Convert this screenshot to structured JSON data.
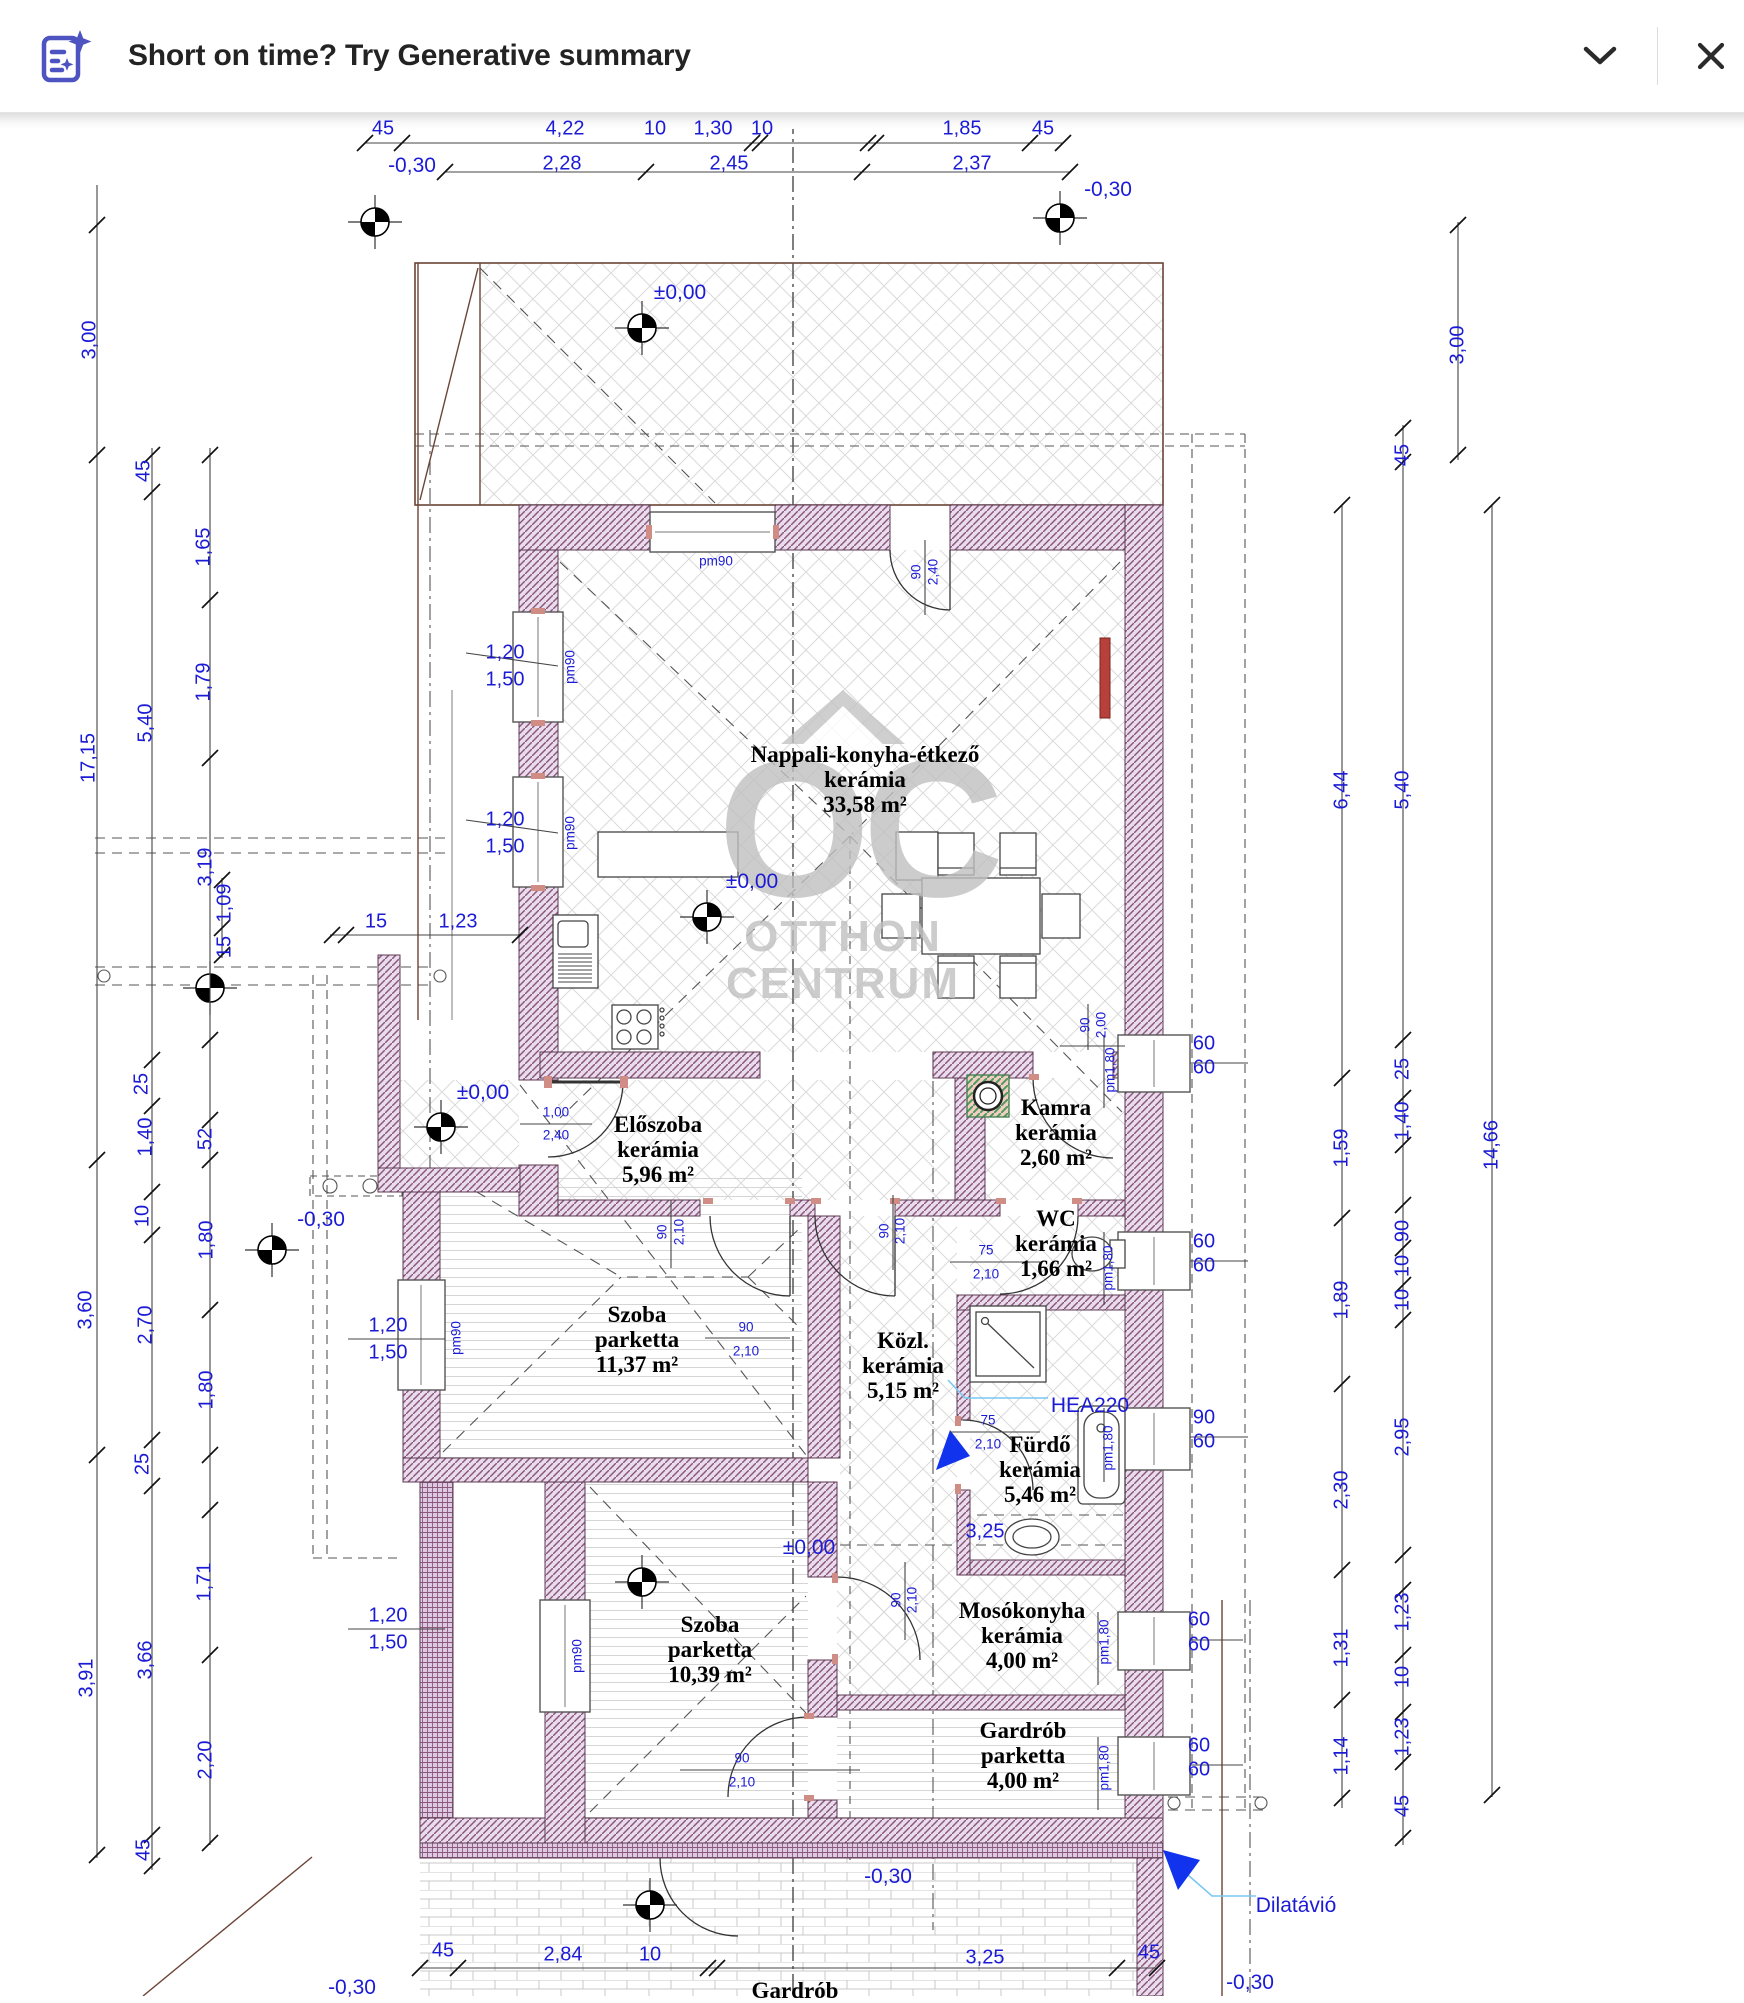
{
  "banner": {
    "title": "Short on time? Try Generative summary",
    "accent_color": "#4d53c0",
    "icon": "generative-summary-icon",
    "chevron_icon": "chevron-down-icon",
    "close_icon": "close-icon"
  },
  "plan": {
    "watermark": {
      "abbr": "OC",
      "line1": "OTTHON",
      "line2": "CENTRUM"
    },
    "rooms": [
      {
        "name": "Nappali-konyha-étkező",
        "floor": "kerámia",
        "area": "33,58 m²",
        "x": 865,
        "y": 742
      },
      {
        "name": "Előszoba",
        "floor": "kerámia",
        "area": "5,96 m²",
        "x": 658,
        "y": 1112
      },
      {
        "name": "Kamra",
        "floor": "kerámia",
        "area": "2,60 m²",
        "x": 1056,
        "y": 1095
      },
      {
        "name": "WC",
        "floor": "kerámia",
        "area": "1,66 m²",
        "x": 1056,
        "y": 1206
      },
      {
        "name": "Szoba",
        "floor": "parketta",
        "area": "11,37 m²",
        "x": 637,
        "y": 1302
      },
      {
        "name": "Közl.",
        "floor": "kerámia",
        "area": "5,15 m²",
        "x": 903,
        "y": 1328
      },
      {
        "name": "Fürdő",
        "floor": "kerámia",
        "area": "5,46 m²",
        "x": 1040,
        "y": 1432
      },
      {
        "name": "Mosókonyha",
        "floor": "kerámia",
        "area": "4,00 m²",
        "x": 1022,
        "y": 1598
      },
      {
        "name": "Szoba",
        "floor": "parketta",
        "area": "10,39 m²",
        "x": 710,
        "y": 1612
      },
      {
        "name": "Gardrób",
        "floor": "parketta",
        "area": "4,00 m²",
        "x": 1023,
        "y": 1718
      },
      {
        "name": "Gardrób",
        "floor": "",
        "area": "",
        "x": 795,
        "y": 1978
      }
    ],
    "labels": [
      {
        "t": "45",
        "x": 383,
        "y": 129
      },
      {
        "t": "4,22",
        "x": 565,
        "y": 129
      },
      {
        "t": "10",
        "x": 655,
        "y": 129
      },
      {
        "t": "1,30",
        "x": 713,
        "y": 129
      },
      {
        "t": "10",
        "x": 762,
        "y": 129
      },
      {
        "t": "1,85",
        "x": 962,
        "y": 129
      },
      {
        "t": "45",
        "x": 1043,
        "y": 129
      },
      {
        "t": "-0,30",
        "x": 412,
        "y": 166,
        "c": "lvl"
      },
      {
        "t": "2,28",
        "x": 562,
        "y": 164
      },
      {
        "t": "2,45",
        "x": 729,
        "y": 164
      },
      {
        "t": "2,37",
        "x": 972,
        "y": 164
      },
      {
        "t": "-0,30",
        "x": 1108,
        "y": 190,
        "c": "lvl"
      },
      {
        "t": "3,00",
        "x": 90,
        "y": 340,
        "r": -90
      },
      {
        "t": "17,15",
        "x": 89,
        "y": 758,
        "r": -90
      },
      {
        "t": "3,60",
        "x": 86,
        "y": 1310,
        "r": -90
      },
      {
        "t": "3,91",
        "x": 87,
        "y": 1678,
        "r": -90
      },
      {
        "t": "45",
        "x": 144,
        "y": 471,
        "r": -90
      },
      {
        "t": "5,40",
        "x": 146,
        "y": 723,
        "r": -90
      },
      {
        "t": "25",
        "x": 142,
        "y": 1084,
        "r": -90
      },
      {
        "t": "1,40",
        "x": 146,
        "y": 1137,
        "r": -90
      },
      {
        "t": "10",
        "x": 143,
        "y": 1216,
        "r": -90
      },
      {
        "t": "2,70",
        "x": 146,
        "y": 1325,
        "r": -90
      },
      {
        "t": "25",
        "x": 143,
        "y": 1464,
        "r": -90
      },
      {
        "t": "3,66",
        "x": 146,
        "y": 1660,
        "r": -90
      },
      {
        "t": "45",
        "x": 144,
        "y": 1850,
        "r": -90
      },
      {
        "t": "1,65",
        "x": 204,
        "y": 547,
        "r": -90
      },
      {
        "t": "1,79",
        "x": 204,
        "y": 682,
        "r": -90
      },
      {
        "t": "3,19",
        "x": 206,
        "y": 867,
        "r": -90
      },
      {
        "t": "52",
        "x": 206,
        "y": 1139,
        "r": -90
      },
      {
        "t": "1,80",
        "x": 207,
        "y": 1240,
        "r": -90
      },
      {
        "t": "1,80",
        "x": 207,
        "y": 1390,
        "r": -90
      },
      {
        "t": "1,71",
        "x": 205,
        "y": 1582,
        "r": -90
      },
      {
        "t": "2,20",
        "x": 206,
        "y": 1760,
        "r": -90
      },
      {
        "t": "1,09",
        "x": 225,
        "y": 903,
        "r": -90
      },
      {
        "t": "15",
        "x": 225,
        "y": 947,
        "r": -90
      },
      {
        "t": "15",
        "x": 376,
        "y": 922
      },
      {
        "t": "1,23",
        "x": 458,
        "y": 922
      },
      {
        "t": "6,44",
        "x": 1342,
        "y": 790,
        "r": -90
      },
      {
        "t": "1,59",
        "x": 1342,
        "y": 1148,
        "r": -90
      },
      {
        "t": "1,89",
        "x": 1342,
        "y": 1300,
        "r": -90
      },
      {
        "t": "2,30",
        "x": 1342,
        "y": 1490,
        "r": -90
      },
      {
        "t": "1,31",
        "x": 1342,
        "y": 1648,
        "r": -90
      },
      {
        "t": "1,14",
        "x": 1342,
        "y": 1756,
        "r": -90
      },
      {
        "t": "45",
        "x": 1403,
        "y": 455,
        "r": -90
      },
      {
        "t": "5,40",
        "x": 1403,
        "y": 790,
        "r": -90
      },
      {
        "t": "25",
        "x": 1403,
        "y": 1069,
        "r": -90
      },
      {
        "t": "1,40",
        "x": 1403,
        "y": 1121,
        "r": -90
      },
      {
        "t": "90",
        "x": 1403,
        "y": 1231,
        "r": -90
      },
      {
        "t": "10",
        "x": 1403,
        "y": 1266,
        "r": -90
      },
      {
        "t": "10",
        "x": 1403,
        "y": 1300,
        "r": -90
      },
      {
        "t": "2,95",
        "x": 1403,
        "y": 1437,
        "r": -90
      },
      {
        "t": "1,23",
        "x": 1403,
        "y": 1612,
        "r": -90
      },
      {
        "t": "10",
        "x": 1403,
        "y": 1677,
        "r": -90
      },
      {
        "t": "1,23",
        "x": 1403,
        "y": 1737,
        "r": -90
      },
      {
        "t": "45",
        "x": 1403,
        "y": 1806,
        "r": -90
      },
      {
        "t": "3,00",
        "x": 1458,
        "y": 345,
        "r": -90
      },
      {
        "t": "14,66",
        "x": 1492,
        "y": 1145,
        "r": -90
      },
      {
        "t": "pm90",
        "x": 716,
        "y": 561,
        "c": "sm"
      },
      {
        "t": "90",
        "x": 916,
        "y": 572,
        "r": -90,
        "c": "sm"
      },
      {
        "t": "2,40",
        "x": 933,
        "y": 572,
        "r": -90,
        "c": "sm"
      },
      {
        "t": "1,20",
        "x": 505,
        "y": 653,
        "c": "dim"
      },
      {
        "t": "1,50",
        "x": 505,
        "y": 680,
        "c": "dim"
      },
      {
        "t": "pm90",
        "x": 570,
        "y": 667,
        "r": -90,
        "c": "sm"
      },
      {
        "t": "1,20",
        "x": 505,
        "y": 820,
        "c": "dim"
      },
      {
        "t": "1,50",
        "x": 505,
        "y": 847,
        "c": "dim"
      },
      {
        "t": "pm90",
        "x": 570,
        "y": 833,
        "r": -90,
        "c": "sm"
      },
      {
        "t": "1,20",
        "x": 388,
        "y": 1326
      },
      {
        "t": "1,50",
        "x": 388,
        "y": 1353
      },
      {
        "t": "pm90",
        "x": 456,
        "y": 1338,
        "r": -90,
        "c": "sm"
      },
      {
        "t": "1,20",
        "x": 388,
        "y": 1616
      },
      {
        "t": "1,50",
        "x": 388,
        "y": 1643
      },
      {
        "t": "pm90",
        "x": 577,
        "y": 1656,
        "r": -90,
        "c": "sm"
      },
      {
        "t": "1,00",
        "x": 556,
        "y": 1112,
        "c": "sm"
      },
      {
        "t": "2,40",
        "x": 556,
        "y": 1135,
        "c": "sm"
      },
      {
        "t": "90",
        "x": 1085,
        "y": 1025,
        "r": -90,
        "c": "sm"
      },
      {
        "t": "2,00",
        "x": 1101,
        "y": 1025,
        "r": -90,
        "c": "sm"
      },
      {
        "t": "90",
        "x": 662,
        "y": 1232,
        "r": -90,
        "c": "sm"
      },
      {
        "t": "2,10",
        "x": 679,
        "y": 1232,
        "r": -90,
        "c": "sm"
      },
      {
        "t": "90",
        "x": 884,
        "y": 1231,
        "r": -90,
        "c": "sm"
      },
      {
        "t": "2,10",
        "x": 900,
        "y": 1231,
        "r": -90,
        "c": "sm"
      },
      {
        "t": "75",
        "x": 986,
        "y": 1250,
        "c": "sm"
      },
      {
        "t": "2,10",
        "x": 986,
        "y": 1274,
        "c": "sm"
      },
      {
        "t": "90",
        "x": 746,
        "y": 1327,
        "c": "sm"
      },
      {
        "t": "2,10",
        "x": 746,
        "y": 1351,
        "c": "sm"
      },
      {
        "t": "75",
        "x": 988,
        "y": 1420,
        "c": "sm"
      },
      {
        "t": "2,10",
        "x": 988,
        "y": 1444,
        "c": "sm"
      },
      {
        "t": "90",
        "x": 742,
        "y": 1758,
        "c": "sm"
      },
      {
        "t": "2,10",
        "x": 742,
        "y": 1782,
        "c": "sm"
      },
      {
        "t": "90",
        "x": 896,
        "y": 1600,
        "r": -90,
        "c": "sm"
      },
      {
        "t": "2,10",
        "x": 912,
        "y": 1600,
        "r": -90,
        "c": "sm"
      },
      {
        "t": "pm1,80",
        "x": 1110,
        "y": 1070,
        "r": -90,
        "c": "sm"
      },
      {
        "t": "60",
        "x": 1204,
        "y": 1044
      },
      {
        "t": "60",
        "x": 1204,
        "y": 1068
      },
      {
        "t": "pm1,80",
        "x": 1108,
        "y": 1268,
        "r": -90,
        "c": "sm"
      },
      {
        "t": "60",
        "x": 1204,
        "y": 1242
      },
      {
        "t": "60",
        "x": 1204,
        "y": 1266
      },
      {
        "t": "pm1,80",
        "x": 1108,
        "y": 1448,
        "r": -90,
        "c": "sm"
      },
      {
        "t": "90",
        "x": 1204,
        "y": 1418
      },
      {
        "t": "60",
        "x": 1204,
        "y": 1442
      },
      {
        "t": "pm1,80",
        "x": 1104,
        "y": 1642,
        "r": -90,
        "c": "sm"
      },
      {
        "t": "60",
        "x": 1199,
        "y": 1620
      },
      {
        "t": "60",
        "x": 1199,
        "y": 1645
      },
      {
        "t": "pm1,80",
        "x": 1104,
        "y": 1768,
        "r": -90,
        "c": "sm"
      },
      {
        "t": "60",
        "x": 1199,
        "y": 1746
      },
      {
        "t": "60",
        "x": 1199,
        "y": 1770
      },
      {
        "t": "±0,00",
        "x": 680,
        "y": 293,
        "c": "lvl"
      },
      {
        "t": "±0,00",
        "x": 752,
        "y": 882,
        "c": "lvl"
      },
      {
        "t": "±0,00",
        "x": 483,
        "y": 1093,
        "c": "lvl"
      },
      {
        "t": "±0,00",
        "x": 809,
        "y": 1548,
        "c": "lvl"
      },
      {
        "t": "-0,30",
        "x": 321,
        "y": 1220,
        "c": "lvl"
      },
      {
        "t": "-0,30",
        "x": 888,
        "y": 1877,
        "c": "lvl"
      },
      {
        "t": "-0,30",
        "x": 1250,
        "y": 1983,
        "c": "lvl"
      },
      {
        "t": "-0,30",
        "x": 352,
        "y": 1988,
        "c": "lvl"
      },
      {
        "t": "HEA220",
        "x": 1090,
        "y": 1406,
        "c": "note",
        "n": "annotation-hea220"
      },
      {
        "t": "Dilatávió",
        "x": 1296,
        "y": 1906,
        "c": "note",
        "n": "annotation-dilatavio"
      },
      {
        "t": "3,25",
        "x": 985,
        "y": 1532
      },
      {
        "t": "45",
        "x": 443,
        "y": 1951
      },
      {
        "t": "2,84",
        "x": 563,
        "y": 1955
      },
      {
        "t": "10",
        "x": 650,
        "y": 1955
      },
      {
        "t": "3,25",
        "x": 985,
        "y": 1958
      },
      {
        "t": "45",
        "x": 1149,
        "y": 1953
      }
    ]
  }
}
